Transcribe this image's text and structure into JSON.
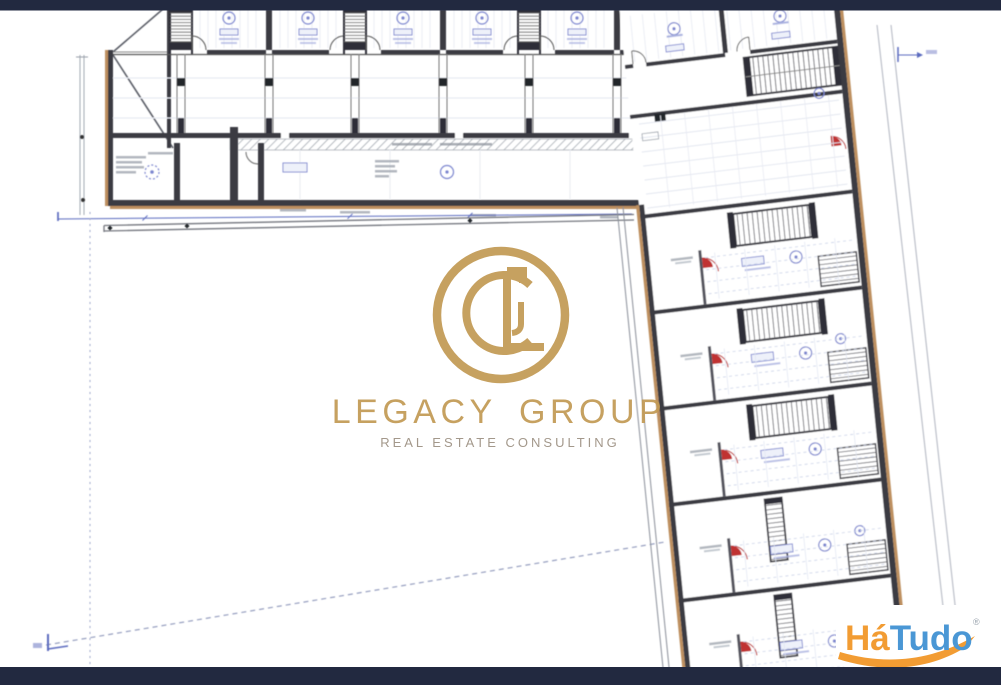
{
  "frame": {
    "bar_color": "#222940"
  },
  "watermark": {
    "brand": "LEGACY GROUP",
    "tagline": "REAL ESTATE CONSULTING",
    "monogram": "CL",
    "gold": "#c29a55",
    "tagline_color": "#9d9183"
  },
  "corner_logo": {
    "ha": "Há",
    "tudo": "Tudo",
    "registered": "®",
    "orange": "#f29c33",
    "blue": "#4a97d5"
  },
  "plan": {
    "colors": {
      "wall": "#3a3a42",
      "wall_dark": "#2f2f37",
      "exterior_trim": "#bd8f5e",
      "annotation_blue": "#7b85cf",
      "dimension_blue": "#5b6bbf",
      "dimension_blue_soft": "#8a93cf",
      "door_red": "#c03030",
      "grid_light": "#e4e7f0",
      "grid_lighter": "#e9ebf2",
      "grid_blue_dash": "#c9d2e8",
      "hatch_gray": "#9aa0a8",
      "text_smudge": "#99a0aa",
      "curb_gray": "#73767e",
      "boundary_gray": "#b6bac4",
      "tread_gray": "#5a5a62"
    }
  }
}
